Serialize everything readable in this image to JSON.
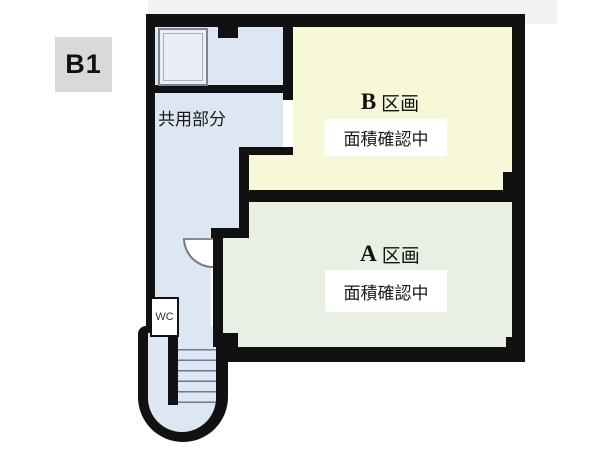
{
  "floor": {
    "label": "B1"
  },
  "rooms": {
    "common": {
      "label": "共用部分"
    },
    "unit_b": {
      "letter": "B",
      "type_label": "区画",
      "status": "面積確認中"
    },
    "unit_a": {
      "letter": "A",
      "type_label": "区画",
      "status": "面積確認中"
    },
    "wc": {
      "label": "WC"
    }
  },
  "colors": {
    "wall": "#111111",
    "common_area": "#dde6f3",
    "unit_b_area": "#f6f8d8",
    "unit_a_area": "#e7f0e2",
    "floor_badge_bg": "#d9d9d9",
    "status_label_bg": "#ffffff",
    "top_strip_bg": "#f2f2f2",
    "elevator_fill": "#e9eef7"
  }
}
